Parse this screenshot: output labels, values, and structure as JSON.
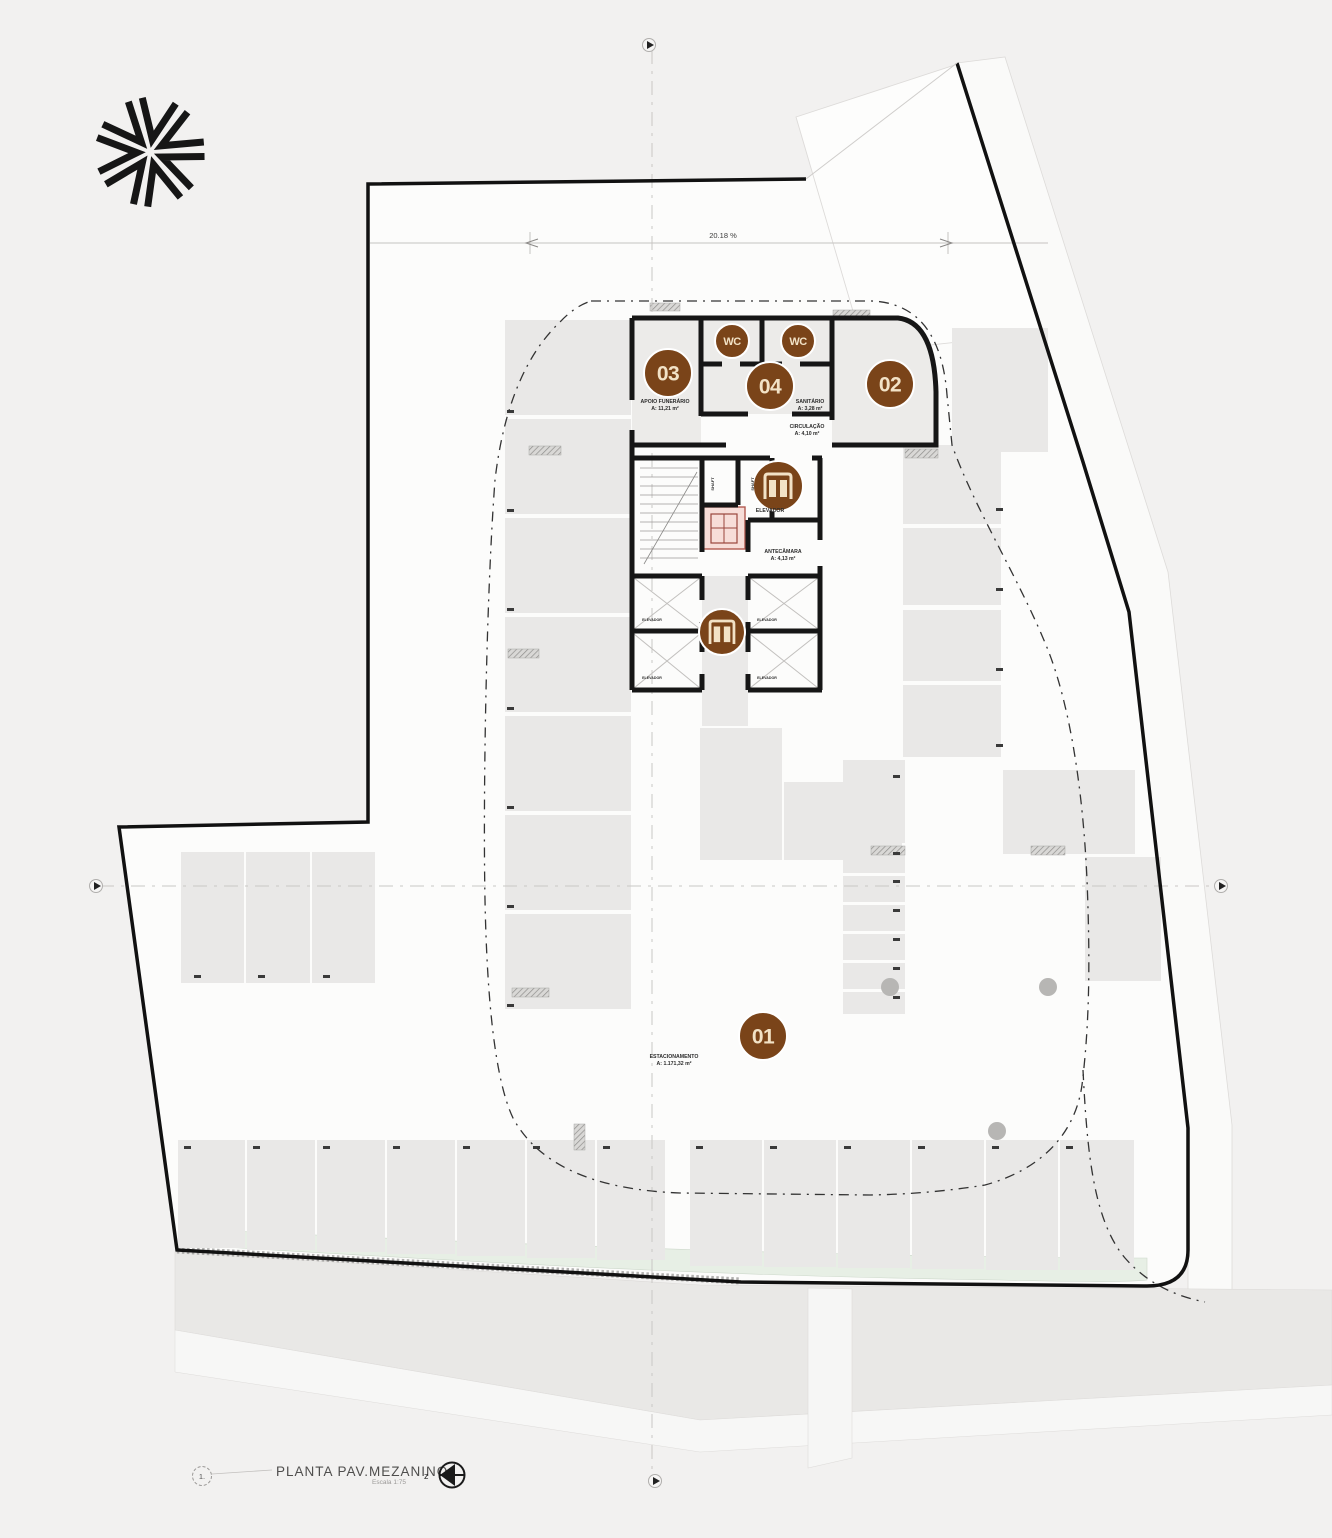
{
  "title_block": {
    "index": "1.",
    "title": "PLANTA PAV.MEZANINO",
    "scale": "Escala 1:75",
    "z_label": "z"
  },
  "dimension": {
    "label": "20.18 %"
  },
  "colors": {
    "paper": "#f2f1f0",
    "plot": "#fcfcfb",
    "wall": "#161616",
    "stall": "#e9e8e7",
    "room": "#ecebe9",
    "corridor": "#eae9e8",
    "badge": "#7a4419",
    "badge_text": "#f2e2c6",
    "green": "#e7efe5",
    "pink": "#f7ddd8",
    "pink_line": "#b25a50",
    "centerline": "#c9c7c5",
    "neighbor_line": "#dddbd9"
  },
  "badges": [
    {
      "id": "unit-03",
      "label": "03",
      "x": 668,
      "y": 373,
      "r": 24,
      "fs": 21
    },
    {
      "id": "wc-left",
      "label": "WC",
      "x": 732,
      "y": 341,
      "r": 17,
      "fs": 11
    },
    {
      "id": "wc-right",
      "label": "WC",
      "x": 798,
      "y": 341,
      "r": 17,
      "fs": 11
    },
    {
      "id": "unit-04",
      "label": "04",
      "x": 770,
      "y": 386,
      "r": 24,
      "fs": 21
    },
    {
      "id": "unit-02",
      "label": "02",
      "x": 890,
      "y": 384,
      "r": 24,
      "fs": 21
    },
    {
      "id": "unit-01",
      "label": "01",
      "x": 763,
      "y": 1036,
      "r": 24,
      "fs": 21
    }
  ],
  "elevator_badges": [
    {
      "id": "elevator-upper",
      "x": 778,
      "y": 486,
      "r": 25
    },
    {
      "id": "elevator-lower",
      "x": 722,
      "y": 632,
      "r": 23
    }
  ],
  "unit_labels": [
    {
      "line1": "APOIO FUNERÁRIO",
      "line2": "A: 11,21 m²",
      "x": 665,
      "y": 403
    },
    {
      "line1": "SANITÁRIO",
      "line2": "A: 3,28 m²",
      "x": 810,
      "y": 403
    },
    {
      "line1": "CIRCULAÇÃO",
      "line2": "A: 4,10 m²",
      "x": 807,
      "y": 428
    },
    {
      "line1": "ELEVADOR",
      "line2": "",
      "x": 770,
      "y": 512
    },
    {
      "line1": "ANTECÂMARA",
      "line2": "A: 4,13 m²",
      "x": 783,
      "y": 553
    },
    {
      "line1": "ESTACIONAMENTO",
      "line2": "A: 1.171,32 m²",
      "x": 674,
      "y": 1058
    }
  ],
  "shaft_labels": [
    {
      "text": "ELEVADOR",
      "x": 652,
      "y": 621
    },
    {
      "text": "ELEVADOR",
      "x": 652,
      "y": 679
    },
    {
      "text": "ELEVADOR",
      "x": 767,
      "y": 621
    },
    {
      "text": "ELEVADOR",
      "x": 767,
      "y": 679
    }
  ],
  "vertical_labels": [
    {
      "text": "SHAFT",
      "x": 714,
      "y": 484
    },
    {
      "text": "SHAFT",
      "x": 754,
      "y": 484
    }
  ],
  "plan": {
    "parking_stalls": [
      [
        505,
        320,
        126,
        95
      ],
      [
        505,
        419,
        126,
        95
      ],
      [
        505,
        518,
        126,
        95
      ],
      [
        505,
        617,
        126,
        95
      ],
      [
        505,
        716,
        126,
        95
      ],
      [
        505,
        815,
        126,
        95
      ],
      [
        505,
        914,
        126,
        95
      ],
      [
        181,
        852,
        63,
        131
      ],
      [
        246,
        852,
        64,
        131
      ],
      [
        312,
        852,
        63,
        131
      ],
      [
        178,
        1140,
        67,
        108
      ],
      [
        247,
        1140,
        68,
        110
      ],
      [
        317,
        1140,
        68,
        112
      ],
      [
        387,
        1140,
        68,
        114
      ],
      [
        457,
        1140,
        68,
        116
      ],
      [
        527,
        1140,
        68,
        118
      ],
      [
        597,
        1140,
        68,
        120
      ],
      [
        690,
        1140,
        72,
        126
      ],
      [
        764,
        1140,
        72,
        127
      ],
      [
        838,
        1140,
        72,
        128
      ],
      [
        912,
        1140,
        72,
        129
      ],
      [
        986,
        1140,
        72,
        130
      ],
      [
        1060,
        1140,
        74,
        130
      ],
      [
        952,
        328,
        96,
        124
      ],
      [
        903,
        445,
        98,
        79
      ],
      [
        903,
        528,
        98,
        77
      ],
      [
        903,
        610,
        98,
        71
      ],
      [
        903,
        685,
        98,
        72
      ],
      [
        700,
        728,
        82,
        132
      ],
      [
        784,
        782,
        118,
        78
      ],
      [
        843,
        760,
        62,
        83
      ],
      [
        843,
        847,
        62,
        26
      ],
      [
        843,
        876,
        62,
        26
      ],
      [
        843,
        905,
        62,
        26
      ],
      [
        843,
        934,
        62,
        26
      ],
      [
        843,
        963,
        62,
        26
      ],
      [
        843,
        992,
        62,
        22
      ],
      [
        1003,
        770,
        132,
        84
      ],
      [
        1085,
        857,
        76,
        124
      ]
    ],
    "pillars": [
      [
        529,
        446,
        32,
        9
      ],
      [
        508,
        649,
        31,
        9
      ],
      [
        512,
        988,
        37,
        9
      ],
      [
        650,
        303,
        30,
        8
      ],
      [
        833,
        310,
        37,
        9
      ],
      [
        905,
        449,
        33,
        9
      ],
      [
        871,
        846,
        34,
        9
      ],
      [
        1031,
        846,
        34,
        9
      ],
      [
        574,
        1124,
        11,
        26
      ]
    ],
    "columns": [
      [
        890,
        987
      ],
      [
        1048,
        987
      ],
      [
        997,
        1131
      ]
    ],
    "stall_ticks": [
      [
        507,
        410
      ],
      [
        507,
        509
      ],
      [
        507,
        608
      ],
      [
        507,
        707
      ],
      [
        507,
        806
      ],
      [
        507,
        905
      ],
      [
        507,
        1004
      ],
      [
        194,
        975
      ],
      [
        258,
        975
      ],
      [
        323,
        975
      ],
      [
        184,
        1146
      ],
      [
        253,
        1146
      ],
      [
        323,
        1146
      ],
      [
        393,
        1146
      ],
      [
        463,
        1146
      ],
      [
        533,
        1146
      ],
      [
        603,
        1146
      ],
      [
        696,
        1146
      ],
      [
        770,
        1146
      ],
      [
        844,
        1146
      ],
      [
        918,
        1146
      ],
      [
        992,
        1146
      ],
      [
        1066,
        1146
      ],
      [
        893,
        775
      ],
      [
        893,
        852
      ],
      [
        893,
        880
      ],
      [
        893,
        909
      ],
      [
        893,
        938
      ],
      [
        893,
        967
      ],
      [
        893,
        996
      ],
      [
        996,
        508
      ],
      [
        996,
        588
      ],
      [
        996,
        668
      ],
      [
        996,
        744
      ]
    ]
  }
}
